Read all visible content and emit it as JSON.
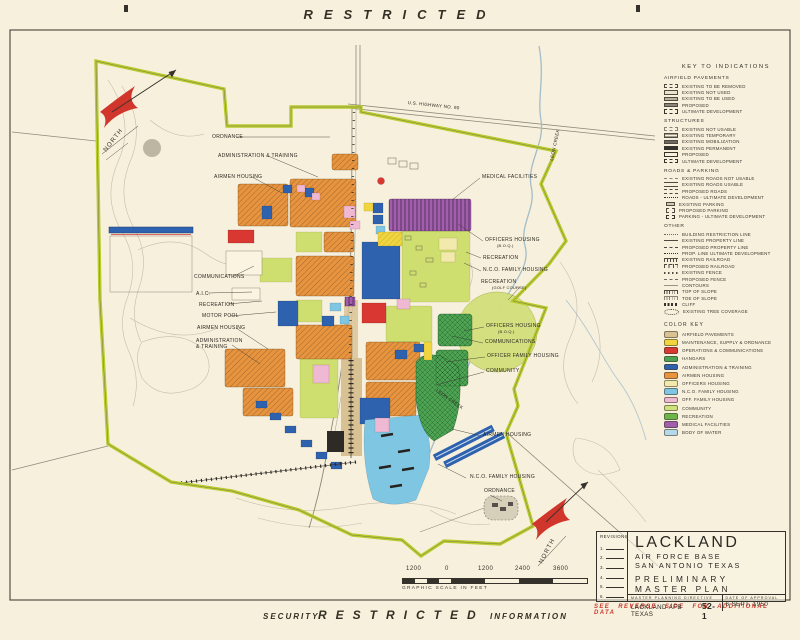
{
  "banner": {
    "top": "RESTRICTED",
    "bottom_left": "SECURITY",
    "bottom_center": "RESTRICTED",
    "bottom_right": "INFORMATION"
  },
  "reverse_note": "SEE REVERSE SIDE FOR ADDITIONAL DATA",
  "colors": {
    "paper": "#f7f0dc",
    "ink": "#35322c",
    "boundary": "#b8cc2e",
    "restricted_red": "#cc3a30"
  },
  "legend": {
    "title": "KEY TO INDICATIONS",
    "sections": [
      {
        "heading": "AIRFIELD PAVEMENTS",
        "items": [
          "EXISTING TO BE REMOVED",
          "EXISTING NOT USED",
          "EXISTING TO BE USED",
          "PROPOSED",
          "ULTIMATE DEVELOPMENT"
        ]
      },
      {
        "heading": "STRUCTURES",
        "items": [
          "EXISTING NOT USABLE",
          "EXISTING TEMPORARY",
          "EXISTING MOBILIZATION",
          "EXISTING PERMANENT",
          "PROPOSED",
          "ULTIMATE DEVELOPMENT"
        ]
      },
      {
        "heading": "ROADS & PARKING",
        "items": [
          "EXISTING ROADS NOT USABLE",
          "EXISTING ROADS USABLE",
          "PROPOSED ROADS",
          "ROADS - ULTIMATE DEVELOPMENT",
          "EXISTING PARKING",
          "PROPOSED PARKING",
          "PARKING - ULTIMATE DEVELOPMENT"
        ]
      },
      {
        "heading": "OTHER",
        "items": [
          "BUILDING RESTRICTION LINE",
          "EXISTING PROPERTY LINE",
          "PROPOSED PROPERTY LINE",
          "PROP. LINE ULTIMATE DEVELOPMENT",
          "EXISTING RAILROAD",
          "PROPOSED RAILROAD",
          "EXISTING FENCE",
          "PROPOSED FENCE",
          "CONTOURS",
          "TOP OF SLOPE",
          "TOE OF SLOPE",
          "CLIFF",
          "EXISTING TREE COVERAGE"
        ]
      }
    ]
  },
  "color_key": {
    "heading": "COLOR KEY",
    "items": [
      {
        "label": "AIRFIELD PAVEMENTS",
        "color": "#d8c193"
      },
      {
        "label": "MAINTENANCE, SUPPLY & ORDNANCE",
        "color": "#f0d53e"
      },
      {
        "label": "OPERATIONS & COMMUNICATIONS",
        "color": "#d93832"
      },
      {
        "label": "HANGARS",
        "color": "#4ca352"
      },
      {
        "label": "ADMINISTRATION & TRAINING",
        "color": "#2f62ae"
      },
      {
        "label": "AIRMEN HOUSING",
        "color": "#e8943e"
      },
      {
        "label": "OFFICERS HOUSING",
        "color": "#f2e9ad"
      },
      {
        "label": "N.C.O. FAMILY HOUSING",
        "color": "#7fc6e2"
      },
      {
        "label": "OFF. FAMILY HOUSING",
        "color": "#efb9d3"
      },
      {
        "label": "COMMUNITY",
        "color": "#cfe17a"
      },
      {
        "label": "RECREATION",
        "color": "#6db54b"
      },
      {
        "label": "MEDICAL FACILITIES",
        "color": "#a05ead"
      },
      {
        "label": "BODY OF WATER",
        "color": "#b7d8e8"
      }
    ]
  },
  "map": {
    "labels": [
      "ORDNANCE",
      "ADMINISTRATION & TRAINING",
      "AIRMEN HOUSING",
      "COMMUNICATIONS",
      "A.I.C.",
      "RECREATION",
      "MOTOR POOL",
      "AIRMEN HOUSING",
      "ADMINISTRATION\n& TRAINING",
      "MEDICAL FACILITIES",
      "OFFICERS HOUSING",
      "(B.O.Q.)",
      "RECREATION",
      "N.C.O. FAMILY HOUSING",
      "RECREATION",
      "(GOLF COURSE)",
      "OFFICERS HOUSING",
      "(B.O.Q.)",
      "COMMUNICATIONS",
      "OFFICER FAMILY HOUSING",
      "COMMUNITY",
      "AIRMEN HOUSING",
      "N.C.O. FAMILY HOUSING",
      "ORDNANCE",
      "U.S. HIGHWAY NO. 90",
      "LEON CREEK",
      "LEON CREEK"
    ]
  },
  "north": {
    "label": "NORTH"
  },
  "scale": {
    "ticks": [
      "1200",
      "0",
      "1200",
      "2400",
      "3600"
    ],
    "caption": "GRAPHIC SCALE IN FEET"
  },
  "title_block": {
    "revisions_heading": "REVISIONS",
    "revision_rows": [
      "1.",
      "2.",
      "3.",
      "4.",
      "5.",
      "6."
    ],
    "base_name": "LACKLAND",
    "base_line2": "AIR FORCE BASE",
    "base_line3": "SAN ANTONIO  TEXAS",
    "plan_title": "PRELIMINARY  MASTER  PLAN",
    "directive_heading": "MASTER  PLANNING  DIRECTIVE",
    "directive_value": "LACKLAND AFB  TEXAS",
    "directive_number": "52-1",
    "approval_heading": "DATE  OF  APPROVAL",
    "approval_date": "6  SEPT. 1950"
  }
}
